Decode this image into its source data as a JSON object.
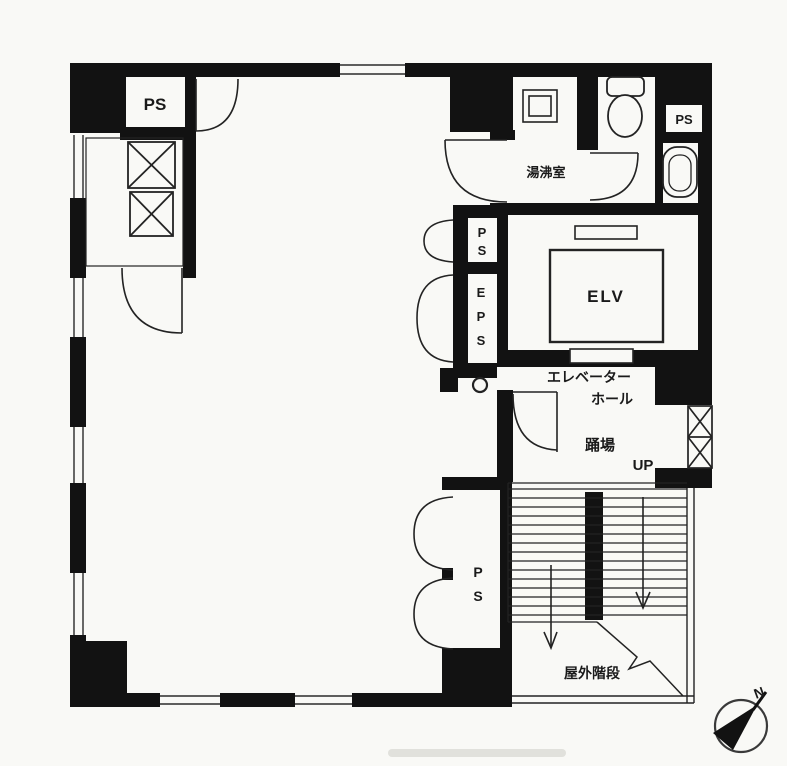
{
  "plan": {
    "paper_color": "#f9f9f6",
    "wall_color": "#121212",
    "line_color": "#232323",
    "labels": {
      "ps_closet_top_left": "PS",
      "kitchenette": "湯沸室",
      "ps_toilet_corner": "PS",
      "elevator": "ELV",
      "ps_shaft_mid": [
        "P",
        "S"
      ],
      "eps_shaft": [
        "E",
        "P",
        "S"
      ],
      "elevator_hall_line1": "エレベーター",
      "elevator_hall_line2": "ホール",
      "landing": "踊場",
      "up": "UP",
      "ps_shaft_bottom": [
        "P",
        "S"
      ],
      "outdoor_stairs": "屋外階段",
      "compass_north": "N"
    }
  }
}
